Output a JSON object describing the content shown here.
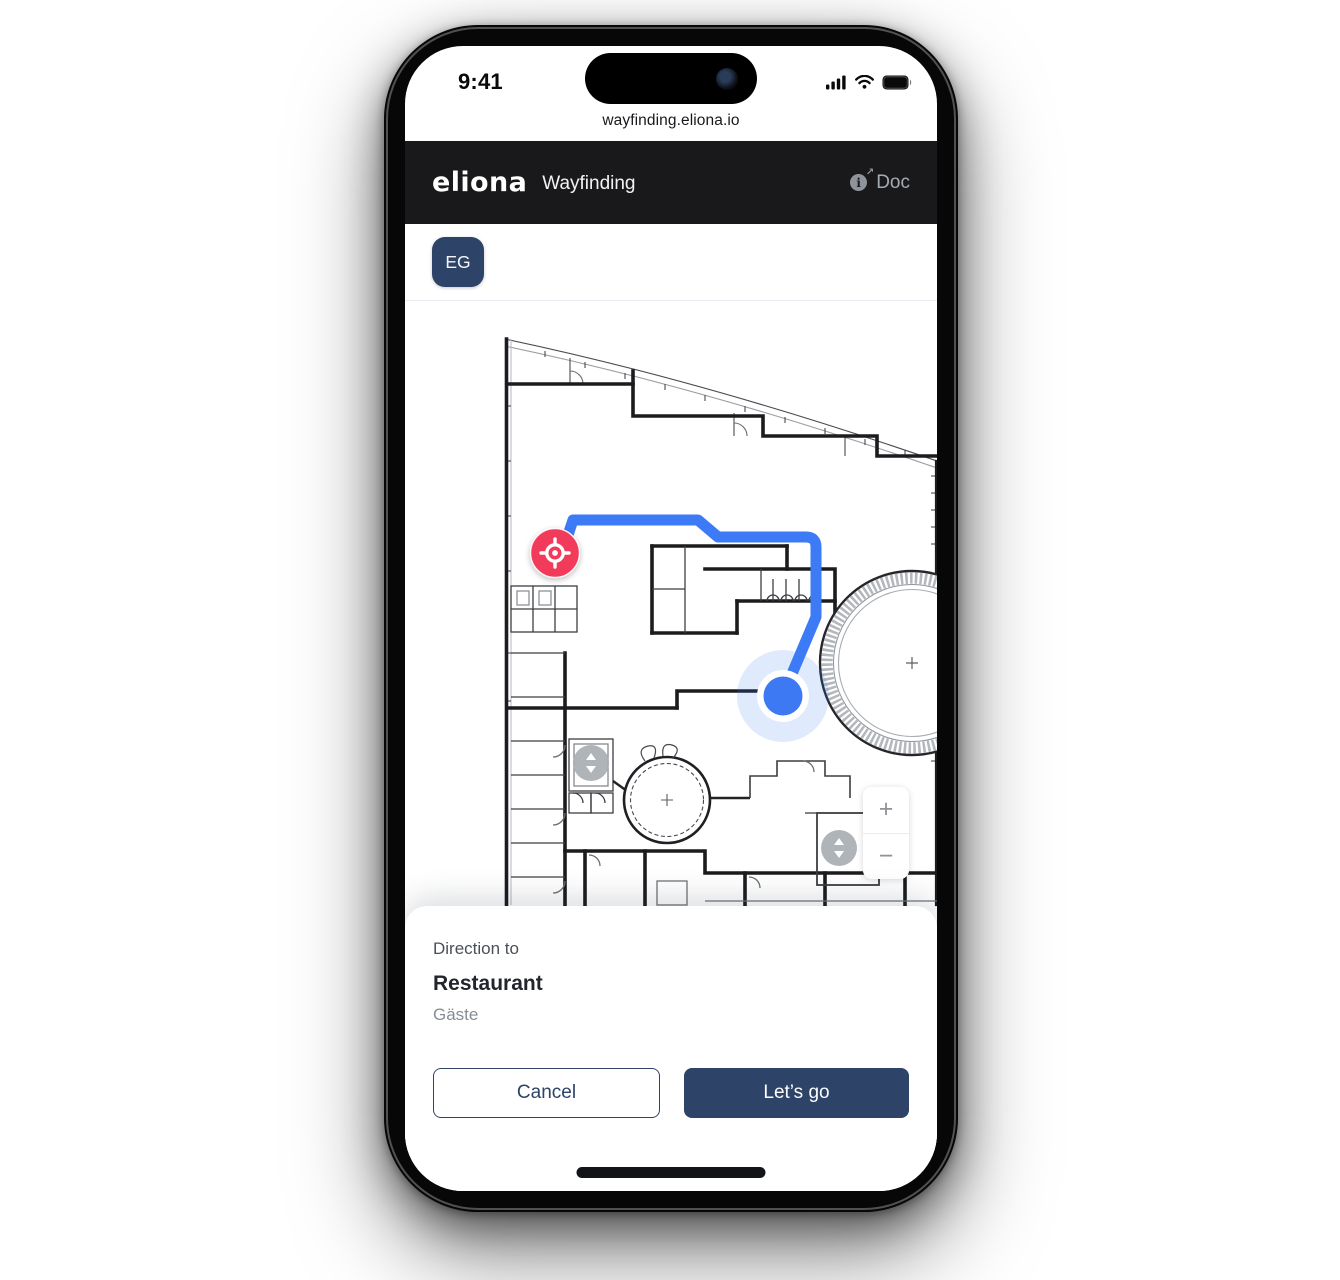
{
  "status_bar": {
    "time": "9:41"
  },
  "browser": {
    "url": "wayfinding.eliona.io"
  },
  "header": {
    "logo": "eliona",
    "title": "Wayfinding",
    "doc_label": "Doc"
  },
  "floor_selector": {
    "current_floor": "EG"
  },
  "map": {
    "zoom_in_label": "+",
    "zoom_out_label": "−",
    "origin_marker": "current-location-target",
    "destination_marker": "destination-dot",
    "elevator_marker": "elevator-up-down"
  },
  "bottom_sheet": {
    "eyebrow": "Direction to",
    "destination_name": "Restaurant",
    "destination_detail": "Gäste",
    "cancel_label": "Cancel",
    "confirm_label": "Let’s go"
  },
  "colors": {
    "navy": "#2d4368",
    "header_bg": "#19191b",
    "route_blue": "#3d7af5",
    "origin_red": "#f23b5a",
    "destination_blue": "#3c79f2",
    "halo_blue": "rgba(61,122,245,0.16)"
  }
}
